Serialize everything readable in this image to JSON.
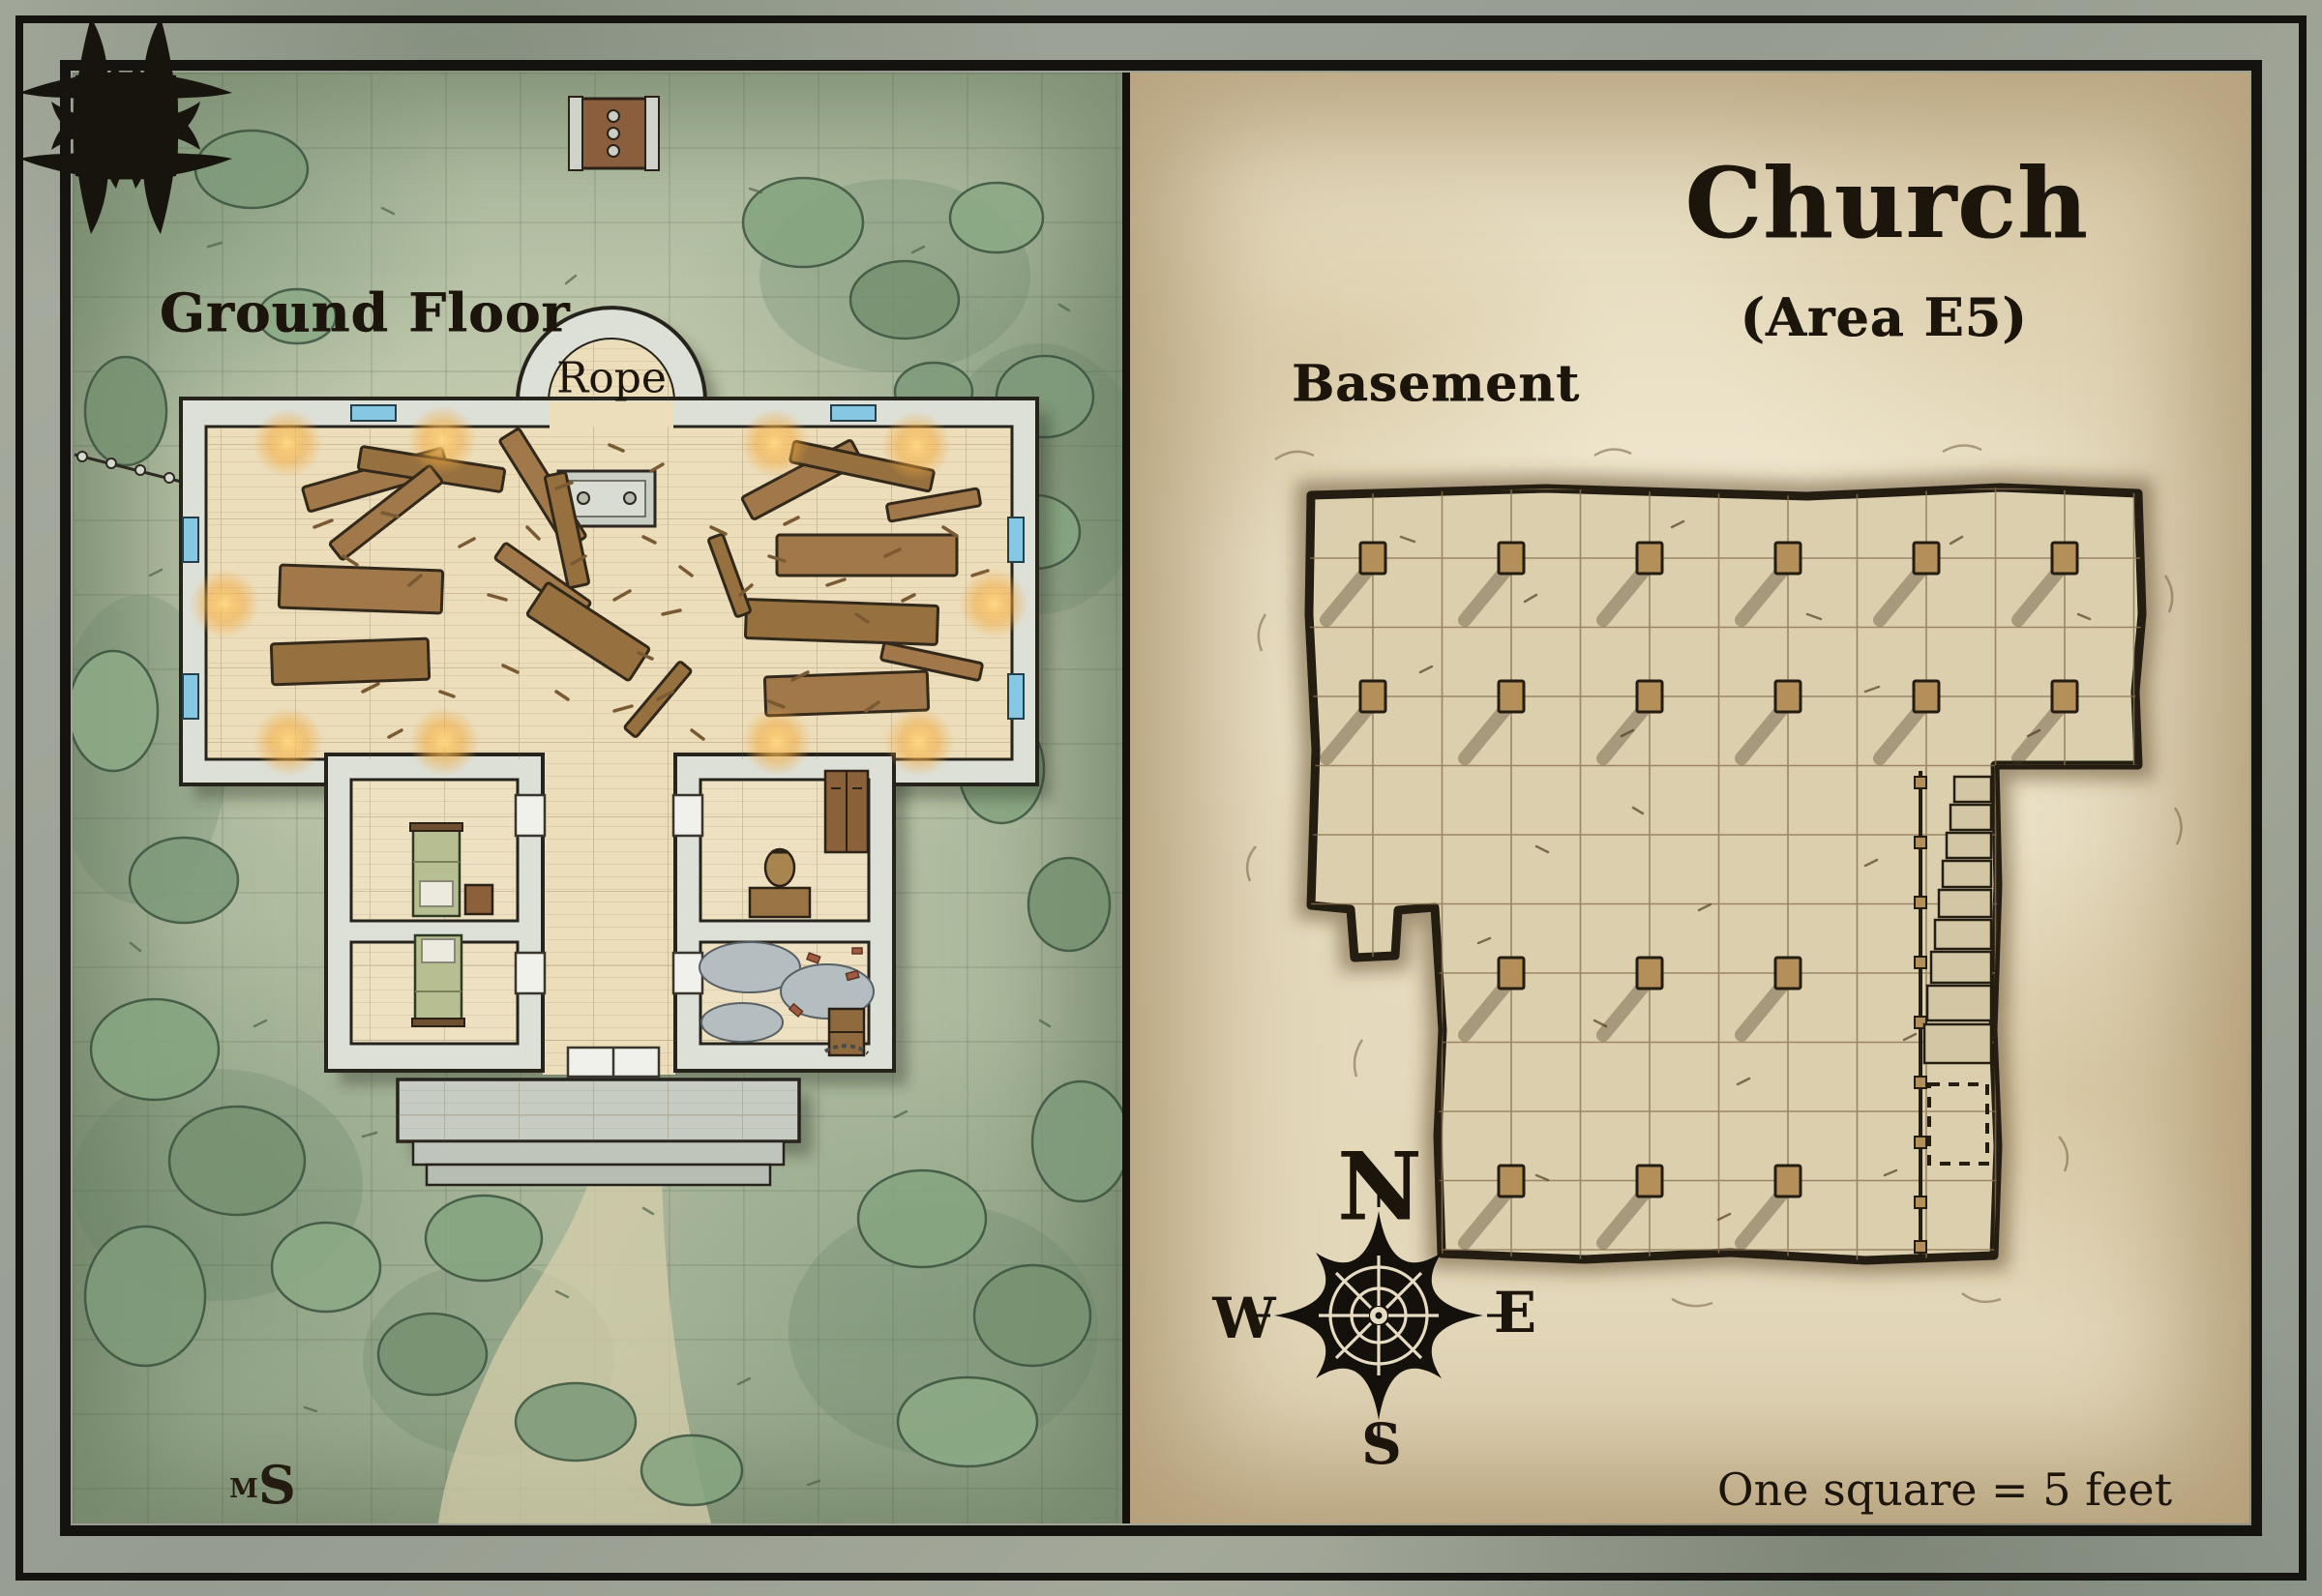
{
  "left_panel": {
    "title": "Ground Floor",
    "rope_label": "Rope",
    "signature": {
      "small": "M",
      "large": "S"
    }
  },
  "right_panel": {
    "title": "Church",
    "subtitle": "(Area E5)",
    "floor_label": "Basement",
    "scale_label": "One square = 5 feet",
    "compass": {
      "n": "N",
      "e": "E",
      "s": "S",
      "w": "W"
    }
  },
  "colors": {
    "parchment": "#e9dfc6",
    "grass": "#b4c0a4",
    "stone_wall": "#dde0d7",
    "wood": "#a1784a",
    "glow": "#f2a93c",
    "ink": "#1c150c",
    "window_glass": "#86c8e4"
  }
}
